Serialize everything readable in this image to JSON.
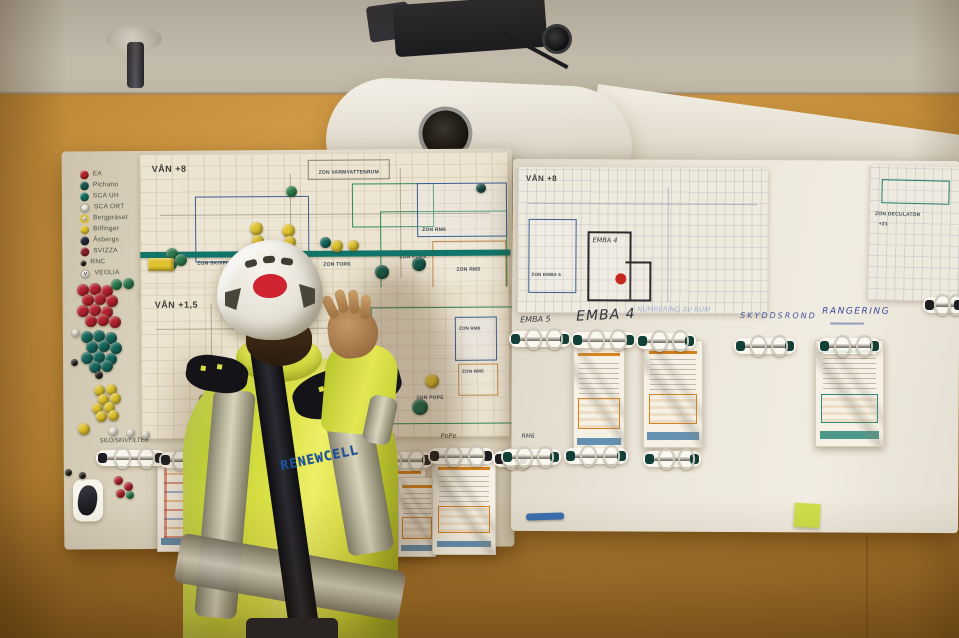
{
  "colors": {
    "wall": "#c89040",
    "ceiling": "#d6d0c3",
    "board_left": "#e0d8c4",
    "board_right": "#ebe6da",
    "tape_teal": "#11756a",
    "hivis_yellow": "#dde34a",
    "reflective_grey": "#b9b4a6",
    "helmet_white": "#efece3",
    "helmet_logo_red": "#cf2430",
    "plan_marker_red": "#c5281c",
    "marker_blue": "#3a6fb0",
    "sticky_note": "#cfe04a",
    "jacket_text_blue": "#1c4f96",
    "magnet_red": "#b3222e",
    "magnet_teal": "#14655b",
    "magnet_green": "#2d7a4c",
    "magnet_yellow": "#dfc22f",
    "magnet_white": "#ece7d9",
    "magnet_navy": "#222b3a",
    "magnet_dark_red": "#8c1e28",
    "magnet_black": "#26231f"
  },
  "left_board": {
    "legend": {
      "items": [
        {
          "label": "EA",
          "color": "#b3222e"
        },
        {
          "label": "Pichano",
          "color": "#15584e"
        },
        {
          "label": "SCA UH",
          "color": "#177060"
        },
        {
          "label": "SCA ORT",
          "color": "#ece7d9",
          "light": true
        },
        {
          "label": "Bergpräset",
          "color": "#f0e9d2",
          "ring": true
        },
        {
          "label": "Bilfinger",
          "color": "#dfc22f"
        },
        {
          "label": "Åsbergs",
          "color": "#222b3a"
        },
        {
          "label": "SVIZZA",
          "color": "#8c1e28"
        },
        {
          "label": "RNC",
          "color": "#26231f",
          "small": true
        },
        {
          "label": "VEOLIA",
          "color": "#f0ece0",
          "light": true,
          "symbol": "V"
        }
      ]
    },
    "plan_upper": {
      "title": "VÅN +8",
      "zone_varmvatten": "ZON VARMVATTENRUM",
      "zone_skivfilter": "ZON SKIVFILTER",
      "zone_tork": "ZON TORK",
      "zone_pope": "ZON POPE",
      "zone_rm6": "ZON RM6",
      "zone_rm5": "ZON RM5"
    },
    "plan_lower": {
      "title": "VÅN +1,5",
      "zone_rm6": "ZON RM6",
      "zone_rm5": "ZON RM5",
      "zone_pope": "ZON POPE"
    },
    "handwritten": {
      "note1": "SILO/SKIVFILTER",
      "note2": "V8",
      "tork": "Tork",
      "pope": "PoPe"
    }
  },
  "right_board": {
    "plan": {
      "title": "VÅN +8",
      "zone_emba4": "EMBA 4",
      "zone_emba5": "ZON EMBA 5"
    },
    "corner_plan": {
      "label": "ZON DECULATOR",
      "sublabel": "+21"
    },
    "headers": {
      "emba5": "EMBA 5",
      "emba4": "EMBA 4",
      "numrering": "NUMRERING AV RUM",
      "skyddsrond": "SKYDDSROND",
      "rangering": "RANGERING"
    },
    "row2": {
      "rm6": "RM6",
      "rm5": "RM5"
    }
  },
  "worker": {
    "jacket_text": "RENEWCELL"
  },
  "magnets": [
    {
      "x": 286,
      "y": 186,
      "d": 11,
      "c": "#2d7a4c"
    },
    {
      "x": 476,
      "y": 183,
      "d": 10,
      "c": "#1d4f46"
    },
    {
      "x": 250,
      "y": 222,
      "d": 13,
      "c": "#dfc22f"
    },
    {
      "x": 252,
      "y": 235,
      "d": 12,
      "c": "#dfc22f"
    },
    {
      "x": 282,
      "y": 224,
      "d": 13,
      "c": "#dfc22f"
    },
    {
      "x": 284,
      "y": 236,
      "d": 12,
      "c": "#dfc22f"
    },
    {
      "x": 320,
      "y": 237,
      "d": 11,
      "c": "#14655b"
    },
    {
      "x": 331,
      "y": 240,
      "d": 12,
      "c": "#dfc22f"
    },
    {
      "x": 348,
      "y": 240,
      "d": 11,
      "c": "#dfc22f"
    },
    {
      "x": 238,
      "y": 251,
      "d": 13,
      "c": "#2d7a4c"
    },
    {
      "x": 247,
      "y": 255,
      "d": 12,
      "c": "#2d7a4c"
    },
    {
      "x": 166,
      "y": 248,
      "d": 12,
      "c": "#2d7a4c"
    },
    {
      "x": 175,
      "y": 254,
      "d": 12,
      "c": "#2d7a4c"
    },
    {
      "x": 166,
      "y": 259,
      "d": 11,
      "c": "#2d7a4c"
    },
    {
      "x": 148,
      "y": 258,
      "w": 26,
      "h": 13,
      "c": "#dfc22f"
    },
    {
      "x": 375,
      "y": 265,
      "d": 14,
      "c": "#15584a"
    },
    {
      "x": 412,
      "y": 257,
      "d": 14,
      "c": "#15584a"
    },
    {
      "x": 425,
      "y": 374,
      "d": 14,
      "c": "#dfc22f"
    },
    {
      "x": 412,
      "y": 399,
      "d": 16,
      "c": "#156a4f"
    },
    {
      "x": 199,
      "y": 394,
      "d": 11,
      "c": "#2a2620"
    },
    {
      "x": 77,
      "y": 284,
      "d": 12,
      "c": "#b3222e"
    },
    {
      "x": 89,
      "y": 283,
      "d": 12,
      "c": "#b3222e"
    },
    {
      "x": 101,
      "y": 285,
      "d": 12,
      "c": "#b3222e"
    },
    {
      "x": 82,
      "y": 294,
      "d": 12,
      "c": "#b3222e"
    },
    {
      "x": 94,
      "y": 293,
      "d": 12,
      "c": "#b3222e"
    },
    {
      "x": 106,
      "y": 295,
      "d": 12,
      "c": "#b3222e"
    },
    {
      "x": 77,
      "y": 305,
      "d": 12,
      "c": "#b3222e"
    },
    {
      "x": 89,
      "y": 304,
      "d": 12,
      "c": "#b3222e"
    },
    {
      "x": 101,
      "y": 306,
      "d": 12,
      "c": "#b3222e"
    },
    {
      "x": 85,
      "y": 315,
      "d": 12,
      "c": "#b3222e"
    },
    {
      "x": 97,
      "y": 314,
      "d": 12,
      "c": "#b3222e"
    },
    {
      "x": 109,
      "y": 316,
      "d": 12,
      "c": "#b3222e"
    },
    {
      "x": 111,
      "y": 279,
      "d": 11,
      "c": "#2d7a4c"
    },
    {
      "x": 123,
      "y": 278,
      "d": 11,
      "c": "#2d7a4c"
    },
    {
      "x": 81,
      "y": 331,
      "d": 12,
      "c": "#14655b"
    },
    {
      "x": 93,
      "y": 330,
      "d": 12,
      "c": "#14655b"
    },
    {
      "x": 105,
      "y": 332,
      "d": 12,
      "c": "#14655b"
    },
    {
      "x": 86,
      "y": 341,
      "d": 12,
      "c": "#14655b"
    },
    {
      "x": 98,
      "y": 340,
      "d": 12,
      "c": "#14655b"
    },
    {
      "x": 110,
      "y": 342,
      "d": 12,
      "c": "#14655b"
    },
    {
      "x": 81,
      "y": 352,
      "d": 12,
      "c": "#14655b"
    },
    {
      "x": 93,
      "y": 351,
      "d": 12,
      "c": "#14655b"
    },
    {
      "x": 105,
      "y": 353,
      "d": 12,
      "c": "#14655b"
    },
    {
      "x": 89,
      "y": 361,
      "d": 12,
      "c": "#14655b"
    },
    {
      "x": 101,
      "y": 360,
      "d": 12,
      "c": "#14655b"
    },
    {
      "x": 71,
      "y": 359,
      "d": 7,
      "c": "#26231f"
    },
    {
      "x": 95,
      "y": 371,
      "d": 8,
      "c": "#26231f"
    },
    {
      "x": 72,
      "y": 329,
      "d": 8,
      "c": "#ece7d9"
    },
    {
      "x": 94,
      "y": 385,
      "d": 11,
      "c": "#dfc22f"
    },
    {
      "x": 106,
      "y": 384,
      "d": 11,
      "c": "#dfc22f"
    },
    {
      "x": 98,
      "y": 394,
      "d": 11,
      "c": "#dfc22f"
    },
    {
      "x": 110,
      "y": 393,
      "d": 11,
      "c": "#dfc22f"
    },
    {
      "x": 92,
      "y": 403,
      "d": 11,
      "c": "#dfc22f"
    },
    {
      "x": 104,
      "y": 402,
      "d": 11,
      "c": "#dfc22f"
    },
    {
      "x": 96,
      "y": 411,
      "d": 11,
      "c": "#dfc22f"
    },
    {
      "x": 108,
      "y": 410,
      "d": 11,
      "c": "#dfc22f"
    },
    {
      "x": 78,
      "y": 423,
      "d": 12,
      "c": "#dfc22f"
    },
    {
      "x": 109,
      "y": 427,
      "d": 9,
      "c": "#ece7d9"
    },
    {
      "x": 127,
      "y": 429,
      "d": 8,
      "c": "#ece7d9"
    },
    {
      "x": 142,
      "y": 431,
      "d": 8,
      "c": "#ece7d9"
    },
    {
      "x": 65,
      "y": 469,
      "d": 7,
      "c": "#26231f"
    },
    {
      "x": 79,
      "y": 472,
      "d": 7,
      "c": "#26231f"
    },
    {
      "x": 114,
      "y": 476,
      "d": 9,
      "c": "#b3222e"
    },
    {
      "x": 124,
      "y": 482,
      "d": 9,
      "c": "#b3222e"
    },
    {
      "x": 116,
      "y": 489,
      "d": 9,
      "c": "#b3222e"
    },
    {
      "x": 126,
      "y": 491,
      "d": 8,
      "c": "#2d7a4c"
    }
  ],
  "rings": [
    {
      "x": 100,
      "y": 450,
      "w": 62,
      "cap": "black"
    },
    {
      "x": 163,
      "y": 452,
      "w": 40,
      "cap": "black"
    },
    {
      "x": 373,
      "y": 452,
      "w": 56,
      "cap": "black"
    },
    {
      "x": 432,
      "y": 448,
      "w": 58,
      "cap": "black"
    },
    {
      "x": 497,
      "y": 451,
      "w": 28,
      "cap": "black"
    },
    {
      "x": 513,
      "y": 331,
      "w": 54,
      "cap": "teal"
    },
    {
      "x": 575,
      "y": 332,
      "w": 57,
      "cap": "teal"
    },
    {
      "x": 640,
      "y": 333,
      "w": 52,
      "cap": "teal"
    },
    {
      "x": 738,
      "y": 338,
      "w": 54,
      "cap": "teal"
    },
    {
      "x": 822,
      "y": 338,
      "w": 55,
      "cap": "teal"
    },
    {
      "x": 505,
      "y": 449,
      "w": 52,
      "cap": "teal"
    },
    {
      "x": 568,
      "y": 448,
      "w": 56,
      "cap": "teal"
    },
    {
      "x": 647,
      "y": 451,
      "w": 50,
      "cap": "teal"
    },
    {
      "x": 927,
      "y": 297,
      "w": 34,
      "cap": "black"
    }
  ],
  "documents": [
    {
      "x": 192,
      "y": 452,
      "w": 62,
      "h": 95,
      "variant": "plain"
    },
    {
      "x": 157,
      "y": 460,
      "w": 48,
      "h": 90,
      "variant": "rows"
    },
    {
      "x": 368,
      "y": 462,
      "w": 56,
      "h": 93,
      "variant": "orange"
    },
    {
      "x": 398,
      "y": 477,
      "w": 36,
      "h": 78,
      "variant": "orange"
    },
    {
      "x": 432,
      "y": 457,
      "w": 62,
      "h": 96,
      "variant": "orange"
    },
    {
      "x": 573,
      "y": 342,
      "w": 50,
      "h": 110,
      "variant": "orange"
    },
    {
      "x": 643,
      "y": 340,
      "w": 58,
      "h": 106,
      "variant": "orange"
    },
    {
      "x": 815,
      "y": 340,
      "w": 67,
      "h": 105,
      "variant": "teal"
    }
  ]
}
